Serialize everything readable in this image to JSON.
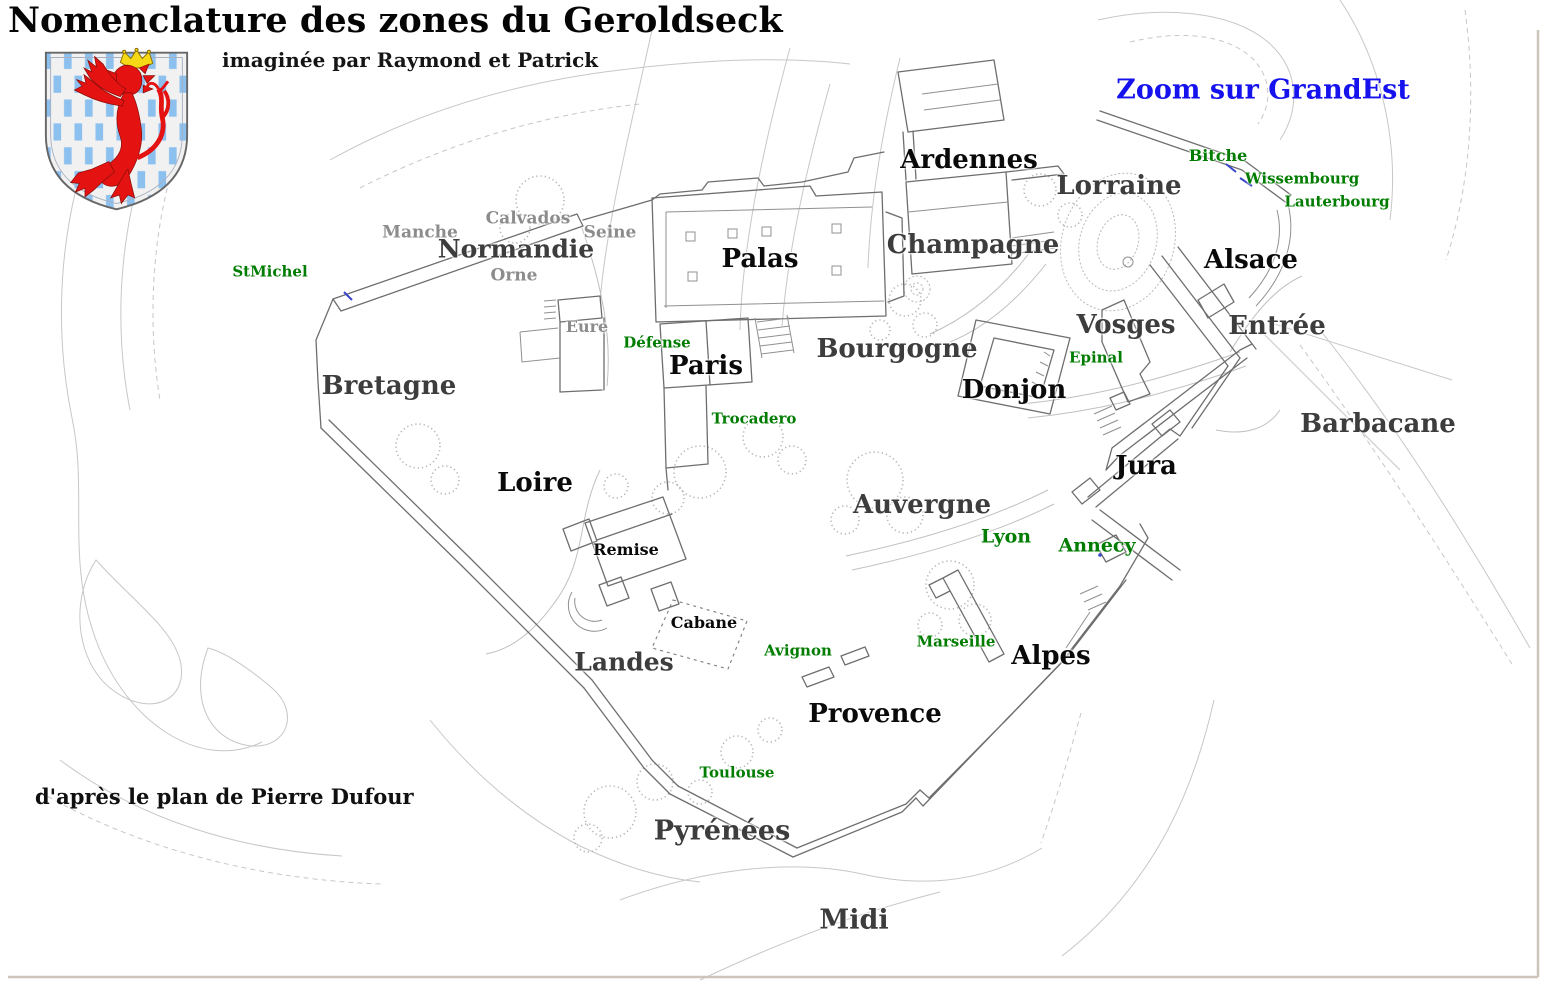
{
  "header": {
    "title": "Nomenclature des zones du Geroldseck",
    "subtitle": "imaginée par Raymond et Patrick",
    "credit": "d'après le plan de Pierre Dufour",
    "zoom_link": "Zoom sur GrandEst"
  },
  "colors": {
    "zone_dark": "#0a0a0a",
    "zone_gray": "#3d3d3d",
    "subzone_gray": "#8c8c8c",
    "poi_green": "#007c00",
    "link_blue": "#1512ee",
    "border": "#cdc5ba"
  },
  "shield": {
    "name": "blason rouge lion couronné sur champ rayé bleu et argent",
    "field": "#f1f1f1",
    "stripe": "#8cc0ef",
    "lion": "#e51212",
    "crown": "#f5d916"
  },
  "map": {
    "labels": [
      {
        "id": "ardennes",
        "text": "Ardennes",
        "x": 969,
        "y": 160,
        "size": 26,
        "color_key": "zone_dark"
      },
      {
        "id": "lorraine",
        "text": "Lorraine",
        "x": 1119,
        "y": 186,
        "size": 26,
        "color_key": "zone_gray"
      },
      {
        "id": "bitche",
        "text": "Bitche",
        "x": 1218,
        "y": 156,
        "size": 16,
        "color_key": "poi_green"
      },
      {
        "id": "wissembourg",
        "text": "Wissembourg",
        "x": 1302,
        "y": 179,
        "size": 15,
        "color_key": "poi_green"
      },
      {
        "id": "lauterbourg",
        "text": "Lauterbourg",
        "x": 1337,
        "y": 202,
        "size": 15,
        "color_key": "poi_green"
      },
      {
        "id": "champagne",
        "text": "Champagne",
        "x": 973,
        "y": 245,
        "size": 26,
        "color_key": "zone_gray"
      },
      {
        "id": "alsace",
        "text": "Alsace",
        "x": 1251,
        "y": 260,
        "size": 26,
        "color_key": "zone_dark"
      },
      {
        "id": "manche",
        "text": "Manche",
        "x": 420,
        "y": 233,
        "size": 17,
        "color_key": "subzone_gray"
      },
      {
        "id": "calvados",
        "text": "Calvados",
        "x": 528,
        "y": 219,
        "size": 17,
        "color_key": "subzone_gray"
      },
      {
        "id": "seine",
        "text": "Seine",
        "x": 610,
        "y": 233,
        "size": 17,
        "color_key": "subzone_gray"
      },
      {
        "id": "normandie",
        "text": "Normandie",
        "x": 516,
        "y": 249,
        "size": 25,
        "color_key": "zone_gray"
      },
      {
        "id": "orne",
        "text": "Orne",
        "x": 514,
        "y": 276,
        "size": 17,
        "color_key": "subzone_gray"
      },
      {
        "id": "stmichel",
        "text": "StMichel",
        "x": 270,
        "y": 272,
        "size": 15,
        "color_key": "poi_green"
      },
      {
        "id": "palas",
        "text": "Palas",
        "x": 760,
        "y": 259,
        "size": 26,
        "color_key": "zone_dark"
      },
      {
        "id": "eure",
        "text": "Eure",
        "x": 587,
        "y": 327,
        "size": 16,
        "color_key": "subzone_gray"
      },
      {
        "id": "defense",
        "text": "Défense",
        "x": 657,
        "y": 343,
        "size": 15,
        "color_key": "poi_green"
      },
      {
        "id": "paris",
        "text": "Paris",
        "x": 706,
        "y": 366,
        "size": 26,
        "color_key": "zone_dark"
      },
      {
        "id": "bourgogne",
        "text": "Bourgogne",
        "x": 897,
        "y": 349,
        "size": 26,
        "color_key": "zone_gray"
      },
      {
        "id": "vosges",
        "text": "Vosges",
        "x": 1126,
        "y": 325,
        "size": 26,
        "color_key": "zone_gray"
      },
      {
        "id": "epinal",
        "text": "Epinal",
        "x": 1096,
        "y": 358,
        "size": 15,
        "color_key": "poi_green"
      },
      {
        "id": "entree",
        "text": "Entrée",
        "x": 1277,
        "y": 326,
        "size": 26,
        "color_key": "zone_gray"
      },
      {
        "id": "donjon",
        "text": "Donjon",
        "x": 1014,
        "y": 390,
        "size": 26,
        "color_key": "zone_dark"
      },
      {
        "id": "trocadero",
        "text": "Trocadero",
        "x": 754,
        "y": 419,
        "size": 15,
        "color_key": "poi_green"
      },
      {
        "id": "barbacane",
        "text": "Barbacane",
        "x": 1378,
        "y": 424,
        "size": 26,
        "color_key": "zone_gray"
      },
      {
        "id": "bretagne",
        "text": "Bretagne",
        "x": 389,
        "y": 386,
        "size": 26,
        "color_key": "zone_gray"
      },
      {
        "id": "jura",
        "text": "Jura",
        "x": 1146,
        "y": 466,
        "size": 26,
        "color_key": "zone_dark"
      },
      {
        "id": "loire",
        "text": "Loire",
        "x": 535,
        "y": 483,
        "size": 26,
        "color_key": "zone_dark"
      },
      {
        "id": "auvergne",
        "text": "Auvergne",
        "x": 922,
        "y": 505,
        "size": 26,
        "color_key": "zone_gray"
      },
      {
        "id": "lyon",
        "text": "Lyon",
        "x": 1006,
        "y": 537,
        "size": 19,
        "color_key": "poi_green"
      },
      {
        "id": "annecy",
        "text": "Annecy",
        "x": 1097,
        "y": 546,
        "size": 19,
        "color_key": "poi_green"
      },
      {
        "id": "remise",
        "text": "Remise",
        "x": 626,
        "y": 550,
        "size": 16,
        "color_key": "zone_dark"
      },
      {
        "id": "cabane",
        "text": "Cabane",
        "x": 704,
        "y": 623,
        "size": 16,
        "color_key": "zone_dark"
      },
      {
        "id": "marseille",
        "text": "Marseille",
        "x": 956,
        "y": 642,
        "size": 15,
        "color_key": "poi_green"
      },
      {
        "id": "avignon",
        "text": "Avignon",
        "x": 798,
        "y": 651,
        "size": 15,
        "color_key": "poi_green"
      },
      {
        "id": "landes",
        "text": "Landes",
        "x": 624,
        "y": 662,
        "size": 25,
        "color_key": "zone_gray"
      },
      {
        "id": "alpes",
        "text": "Alpes",
        "x": 1051,
        "y": 656,
        "size": 26,
        "color_key": "zone_dark"
      },
      {
        "id": "provence",
        "text": "Provence",
        "x": 875,
        "y": 714,
        "size": 26,
        "color_key": "zone_dark"
      },
      {
        "id": "toulouse",
        "text": "Toulouse",
        "x": 737,
        "y": 773,
        "size": 15,
        "color_key": "poi_green"
      },
      {
        "id": "pyrenees",
        "text": "Pyrénées",
        "x": 722,
        "y": 831,
        "size": 27,
        "color_key": "zone_gray"
      },
      {
        "id": "midi",
        "text": "Midi",
        "x": 854,
        "y": 920,
        "size": 27,
        "color_key": "zone_gray"
      }
    ]
  }
}
